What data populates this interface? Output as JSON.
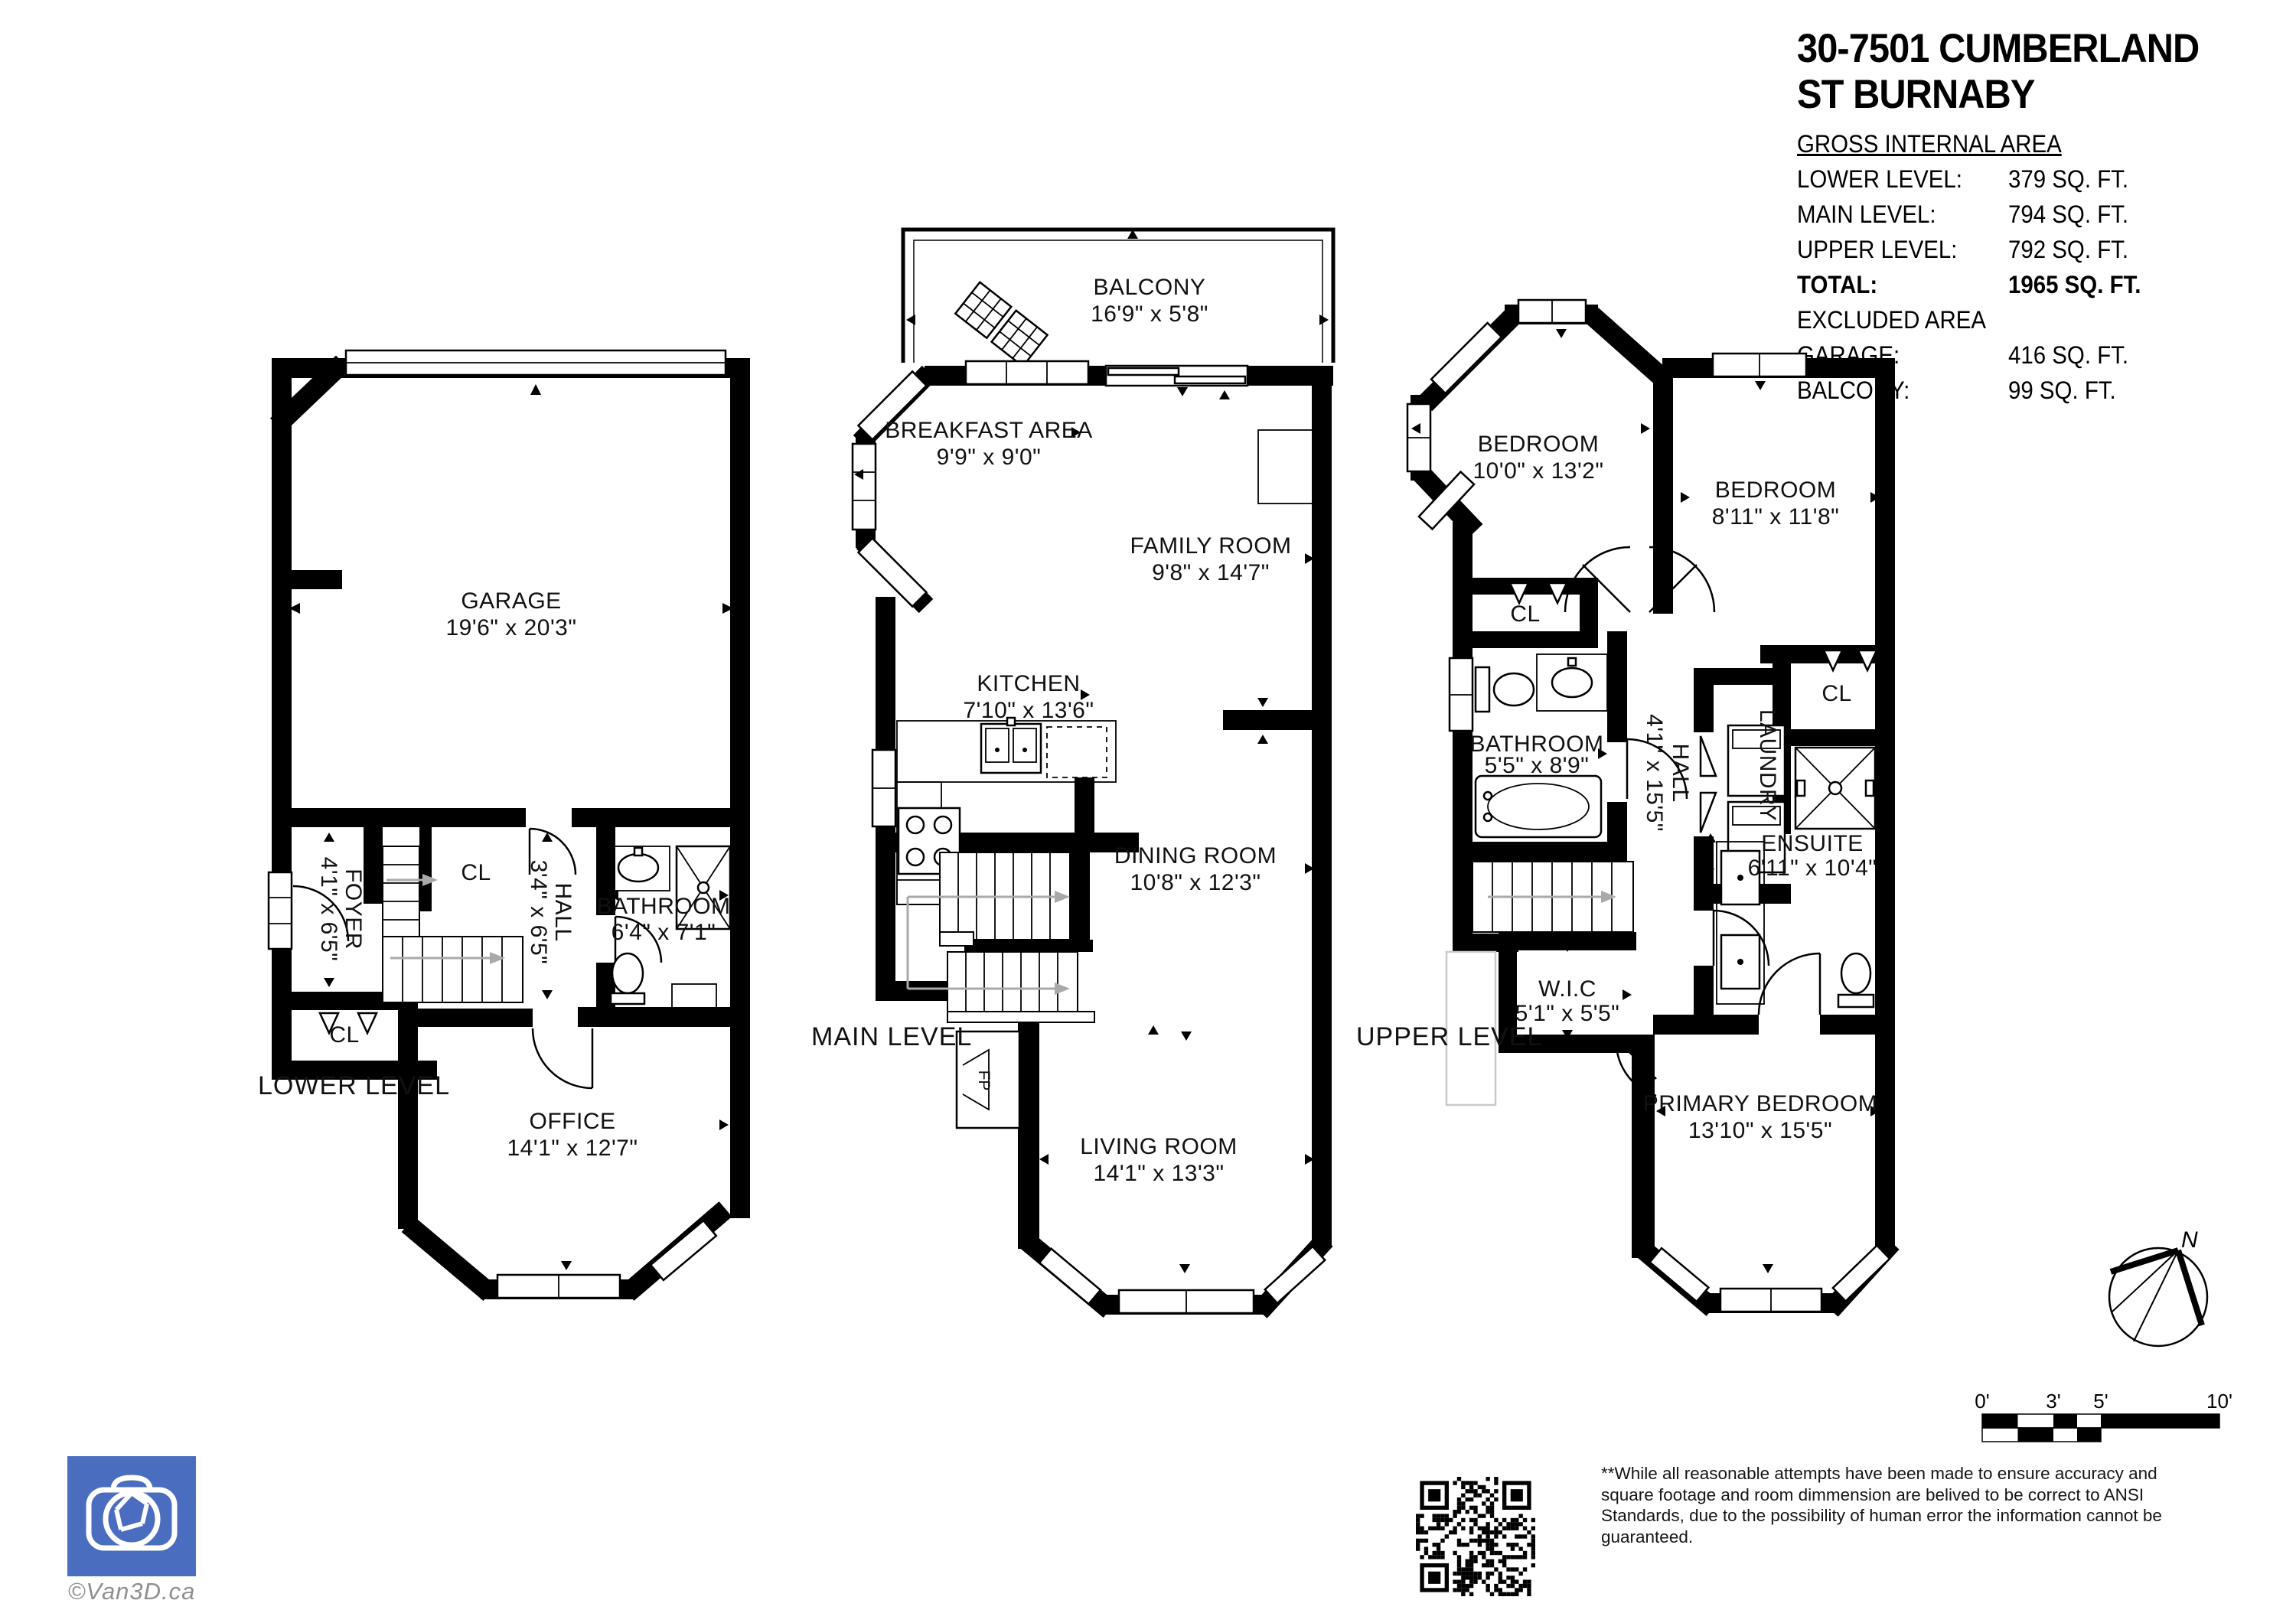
{
  "header": {
    "title_line1": "30-7501 CUMBERLAND",
    "title_line2": "ST BURNABY",
    "gross_label": "GROSS INTERNAL AREA",
    "area_rows": [
      {
        "label": "LOWER LEVEL:",
        "value": "379 SQ. FT."
      },
      {
        "label": "MAIN LEVEL:",
        "value": "794 SQ. FT."
      },
      {
        "label": "UPPER LEVEL:",
        "value": "792 SQ. FT."
      }
    ],
    "total_row": {
      "label": "TOTAL:",
      "value": "1965 SQ. FT."
    },
    "excluded_label": "EXCLUDED AREA",
    "excluded_rows": [
      {
        "label": "GARAGE:",
        "value": "416 SQ. FT."
      },
      {
        "label": "BALCONY:",
        "value": "99 SQ. FT."
      }
    ]
  },
  "plans": {
    "lower": {
      "level_label": "LOWER LEVEL",
      "garage": {
        "name": "GARAGE",
        "dims": "19'6\" x 20'3\""
      },
      "foyer": {
        "name": "FOYER",
        "dims": "4'1\" x 6'5\""
      },
      "cl_top": {
        "name": "CL"
      },
      "hall": {
        "name": "HALL",
        "dims": "3'4\" x 6'5\""
      },
      "bathroom": {
        "name": "BATHROOM",
        "dims": "6'4\" x 7'1\""
      },
      "cl_bottom": {
        "name": "CL"
      },
      "office": {
        "name": "OFFICE",
        "dims": "14'1\" x 12'7\""
      }
    },
    "main": {
      "level_label": "MAIN LEVEL",
      "balcony": {
        "name": "BALCONY",
        "dims": "16'9\" x 5'8\""
      },
      "breakfast": {
        "name": "BREAKFAST AREA",
        "dims": "9'9\" x 9'0\""
      },
      "family": {
        "name": "FAMILY ROOM",
        "dims": "9'8\" x 14'7\""
      },
      "kitchen": {
        "name": "KITCHEN",
        "dims": "7'10\" x 13'6\""
      },
      "dining": {
        "name": "DINING ROOM",
        "dims": "10'8\" x 12'3\""
      },
      "living": {
        "name": "LIVING ROOM",
        "dims": "14'1\" x 13'3\""
      },
      "fireplace": {
        "name": "FP"
      }
    },
    "upper": {
      "level_label": "UPPER LEVEL",
      "bedroom1": {
        "name": "BEDROOM",
        "dims": "10'0\" x 13'2\""
      },
      "bedroom2": {
        "name": "BEDROOM",
        "dims": "8'11\" x 11'8\""
      },
      "cl1": {
        "name": "CL"
      },
      "bathroom": {
        "name": "BATHROOM",
        "dims": "5'5\" x 8'9\""
      },
      "hall": {
        "name": "HALL",
        "dims": "4'1\" x 15'5\""
      },
      "laundry": {
        "name": "LAUNDRY"
      },
      "cl2": {
        "name": "CL"
      },
      "ensuite": {
        "name": "ENSUITE",
        "dims": "6'11\" x 10'4\""
      },
      "wic": {
        "name": "W.I.C",
        "dims": "5'1\" x 5'5\""
      },
      "primary": {
        "name": "PRIMARY BEDROOM",
        "dims": "13'10\" x 15'5\""
      }
    }
  },
  "footer": {
    "logo_caption": "©Van3D.ca",
    "disclaimer_lines": [
      "**While all reasonable attempts have been made to ensure accuracy and",
      "square footage and room dimmension are belived to be correct to ANSI",
      "Standards, due to the possibility of human error the information cannot be",
      "guaranteed."
    ],
    "scale_labels": [
      "0'",
      "3'",
      "5'",
      "10'"
    ],
    "compass_label": "N"
  },
  "colors": {
    "logo_blue": "#4a6dc0",
    "wall_black": "#000000"
  }
}
